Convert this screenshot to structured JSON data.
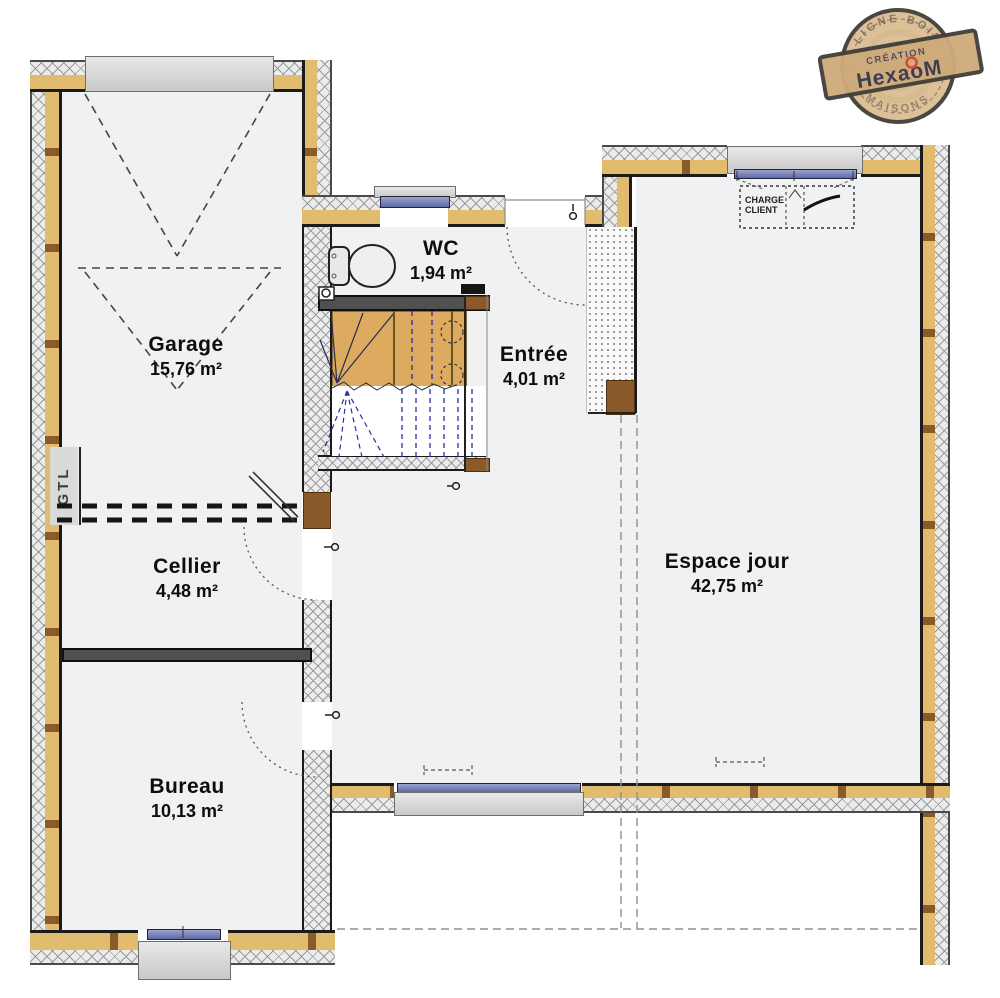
{
  "stamp": {
    "arc_top": "LIGNE BOIS",
    "creation": "CRÉATION",
    "brand": "HexaoM",
    "arc_bottom": "MAISONS"
  },
  "rooms": {
    "garage": {
      "name": "Garage",
      "area": "15,76 m²"
    },
    "wc": {
      "name": "WC",
      "area": "1,94 m²"
    },
    "entree": {
      "name": "Entrée",
      "area": "4,01 m²"
    },
    "cellier": {
      "name": "Cellier",
      "area": "4,48 m²"
    },
    "espace_jour": {
      "name": "Espace jour",
      "area": "42,75 m²"
    },
    "bureau": {
      "name": "Bureau",
      "area": "10,13 m²"
    }
  },
  "annotations": {
    "gtl": "GTL",
    "charge_line1": "CHARGE",
    "charge_line2": "CLIENT"
  },
  "colors": {
    "wall_insulation": "#e2bc6e",
    "wood_block": "#8a5a2b",
    "stair_wood": "#dcab60",
    "window_glass": "#7f89c0",
    "window_sill": "#d6d6d6",
    "room_fill": "#eff1f2",
    "line": "#1b1b1b",
    "stair_dash_blue": "#2b2ba8",
    "stamp_wood": "#d8ba8d",
    "stamp_red": "#d63425"
  }
}
